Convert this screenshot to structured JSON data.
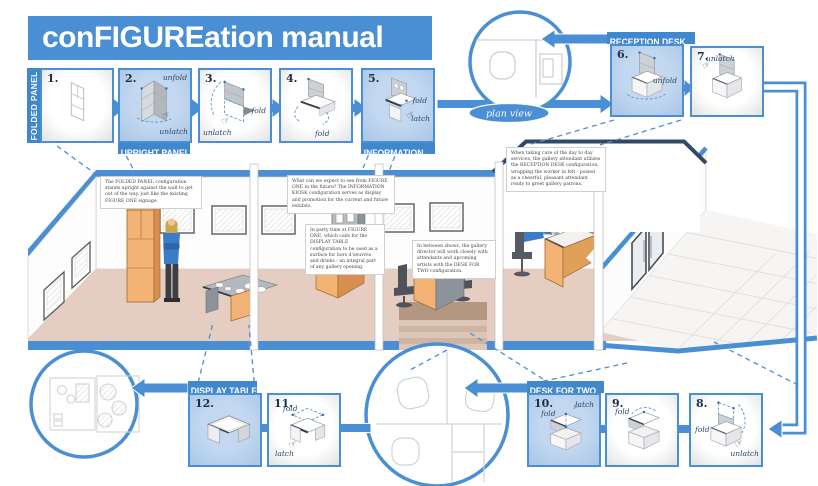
{
  "title": "conFIGUREation manual",
  "plan_view": "plan view",
  "signage": {
    "wall_line1": "FIGURE",
    "wall_line2": "ONE",
    "door": "FIGURE ONE"
  },
  "icons": {
    "hand_pointer": "☞"
  },
  "colors": {
    "accent_blue": "#4a8fd4",
    "label_blue": "#4187cc",
    "highlight_blue": "#b5cfeb",
    "navy_outline": "#2f4a66",
    "floor_pink": "#e6cdc2",
    "furniture_orange": "#f2b374",
    "panel_gray": "#b9bdc3",
    "dark_edge": "#3a3f46"
  },
  "steps": [
    {
      "num": "1.",
      "label": "FOLDED PANEL"
    },
    {
      "num": "2.",
      "label": "UPRIGHT PANEL",
      "ann1": "unfold",
      "ann2": "unlatch"
    },
    {
      "num": "3.",
      "ann1": "fold",
      "ann2": "unlatch"
    },
    {
      "num": "4.",
      "ann1": "fold"
    },
    {
      "num": "5.",
      "label": "INFORMATION",
      "ann1": "fold",
      "ann2": "latch"
    },
    {
      "num": "6.",
      "label": "RECEPTION DESK",
      "ann1": "unfold"
    },
    {
      "num": "7.",
      "ann1": "unlatch"
    },
    {
      "num": "8.",
      "ann1": "fold",
      "ann2": "unlatch"
    },
    {
      "num": "9.",
      "ann1": "fold"
    },
    {
      "num": "10.",
      "label": "DESK FOR TWO",
      "ann1": "fold",
      "ann2": "latch"
    },
    {
      "num": "11.",
      "ann1": "fold",
      "ann2": "latch"
    },
    {
      "num": "12.",
      "label": "DISPLAY TABLE"
    }
  ],
  "notes": {
    "folded_panel": "The FOLDED PANEL configuration stands upright against the wall to get out of the way, just like the existing FIGURE ONE signage.",
    "information": "What can we expect to see from FIGURE ONE in the future? The INFORMATION KIOSK configuration serves as display and promotion for the current and future exhibits.",
    "reception": "When taking care of the day to day services, the gallery attendant utilizes the RECEPTION DESK configuration, wrapping the worker in felt - poised as a cheerful, pleasant attendant ready to greet gallery patrons.",
    "display_table": "In party time at FIGURE ONE, which calls for the DISPLAY TABLE configuration to be used as a surface for hors d'oeuvres and drinks - an integral part of any gallery opening.",
    "desk_for_two": "In between shows, the gallery director will work closely with attendants and upcoming artists with the DESK FOR TWO configuration."
  }
}
